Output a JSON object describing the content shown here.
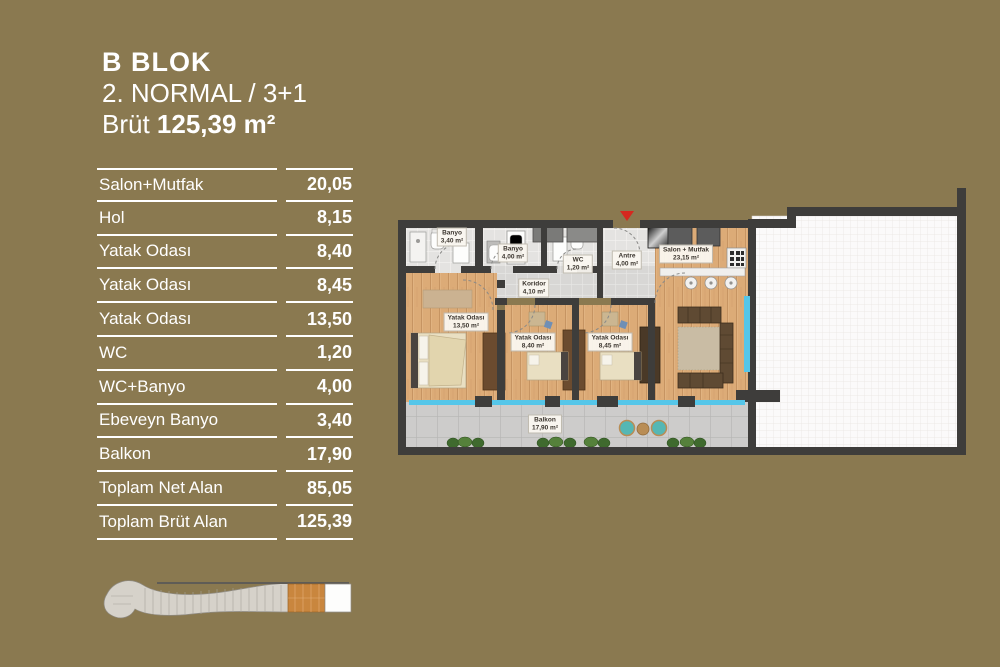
{
  "title": {
    "block": "B BLOK",
    "type_line": "2. NORMAL / 3+1",
    "gross_prefix": "Brüt ",
    "gross_value": "125,39 m²"
  },
  "area_table": {
    "rows": [
      {
        "label": "Salon+Mutfak",
        "value": "20,05"
      },
      {
        "label": "Hol",
        "value": "8,15"
      },
      {
        "label": "Yatak Odası",
        "value": "8,40"
      },
      {
        "label": "Yatak Odası",
        "value": "8,45"
      },
      {
        "label": "Yatak Odası",
        "value": "13,50"
      },
      {
        "label": "WC",
        "value": "1,20"
      },
      {
        "label": "WC+Banyo",
        "value": "4,00"
      },
      {
        "label": "Ebeveyn Banyo",
        "value": "3,40"
      },
      {
        "label": "Balkon",
        "value": "17,90"
      },
      {
        "label": "Toplam Net Alan",
        "value": "85,05"
      },
      {
        "label": "Toplam Brüt Alan",
        "value": "125,39"
      }
    ]
  },
  "floorplan": {
    "rooms": [
      {
        "name": "Banyo",
        "area": "3,40 m²"
      },
      {
        "name": "Banyo",
        "area": "4,00 m²"
      },
      {
        "name": "WC",
        "area": "1,20 m²"
      },
      {
        "name": "Antre",
        "area": "4,00 m²"
      },
      {
        "name": "Salon + Mutfak",
        "area": "23,15 m²"
      },
      {
        "name": "Koridor",
        "area": "4,10 m²"
      },
      {
        "name": "Yatak Odası",
        "area": "13,50 m²"
      },
      {
        "name": "Yatak Odası",
        "area": "8,40 m²"
      },
      {
        "name": "Yatak Odası",
        "area": "8,45 m²"
      },
      {
        "name": "Balkon",
        "area": "17,90 m²"
      }
    ],
    "colors": {
      "wall": "#3e3d3b",
      "glass": "#55c6e9",
      "entrance_marker": "#d6281f",
      "wood_floor": "#dcab77",
      "bath_tile": "#e4e3e1",
      "balcony_tile": "#cdcccb",
      "terrace": "#fbfafa"
    }
  },
  "key_plan": {
    "highlight_color": "#c9863e",
    "body_color": "#d6d2ca"
  },
  "page": {
    "background": "#8a7950",
    "text": "#ffffff"
  }
}
